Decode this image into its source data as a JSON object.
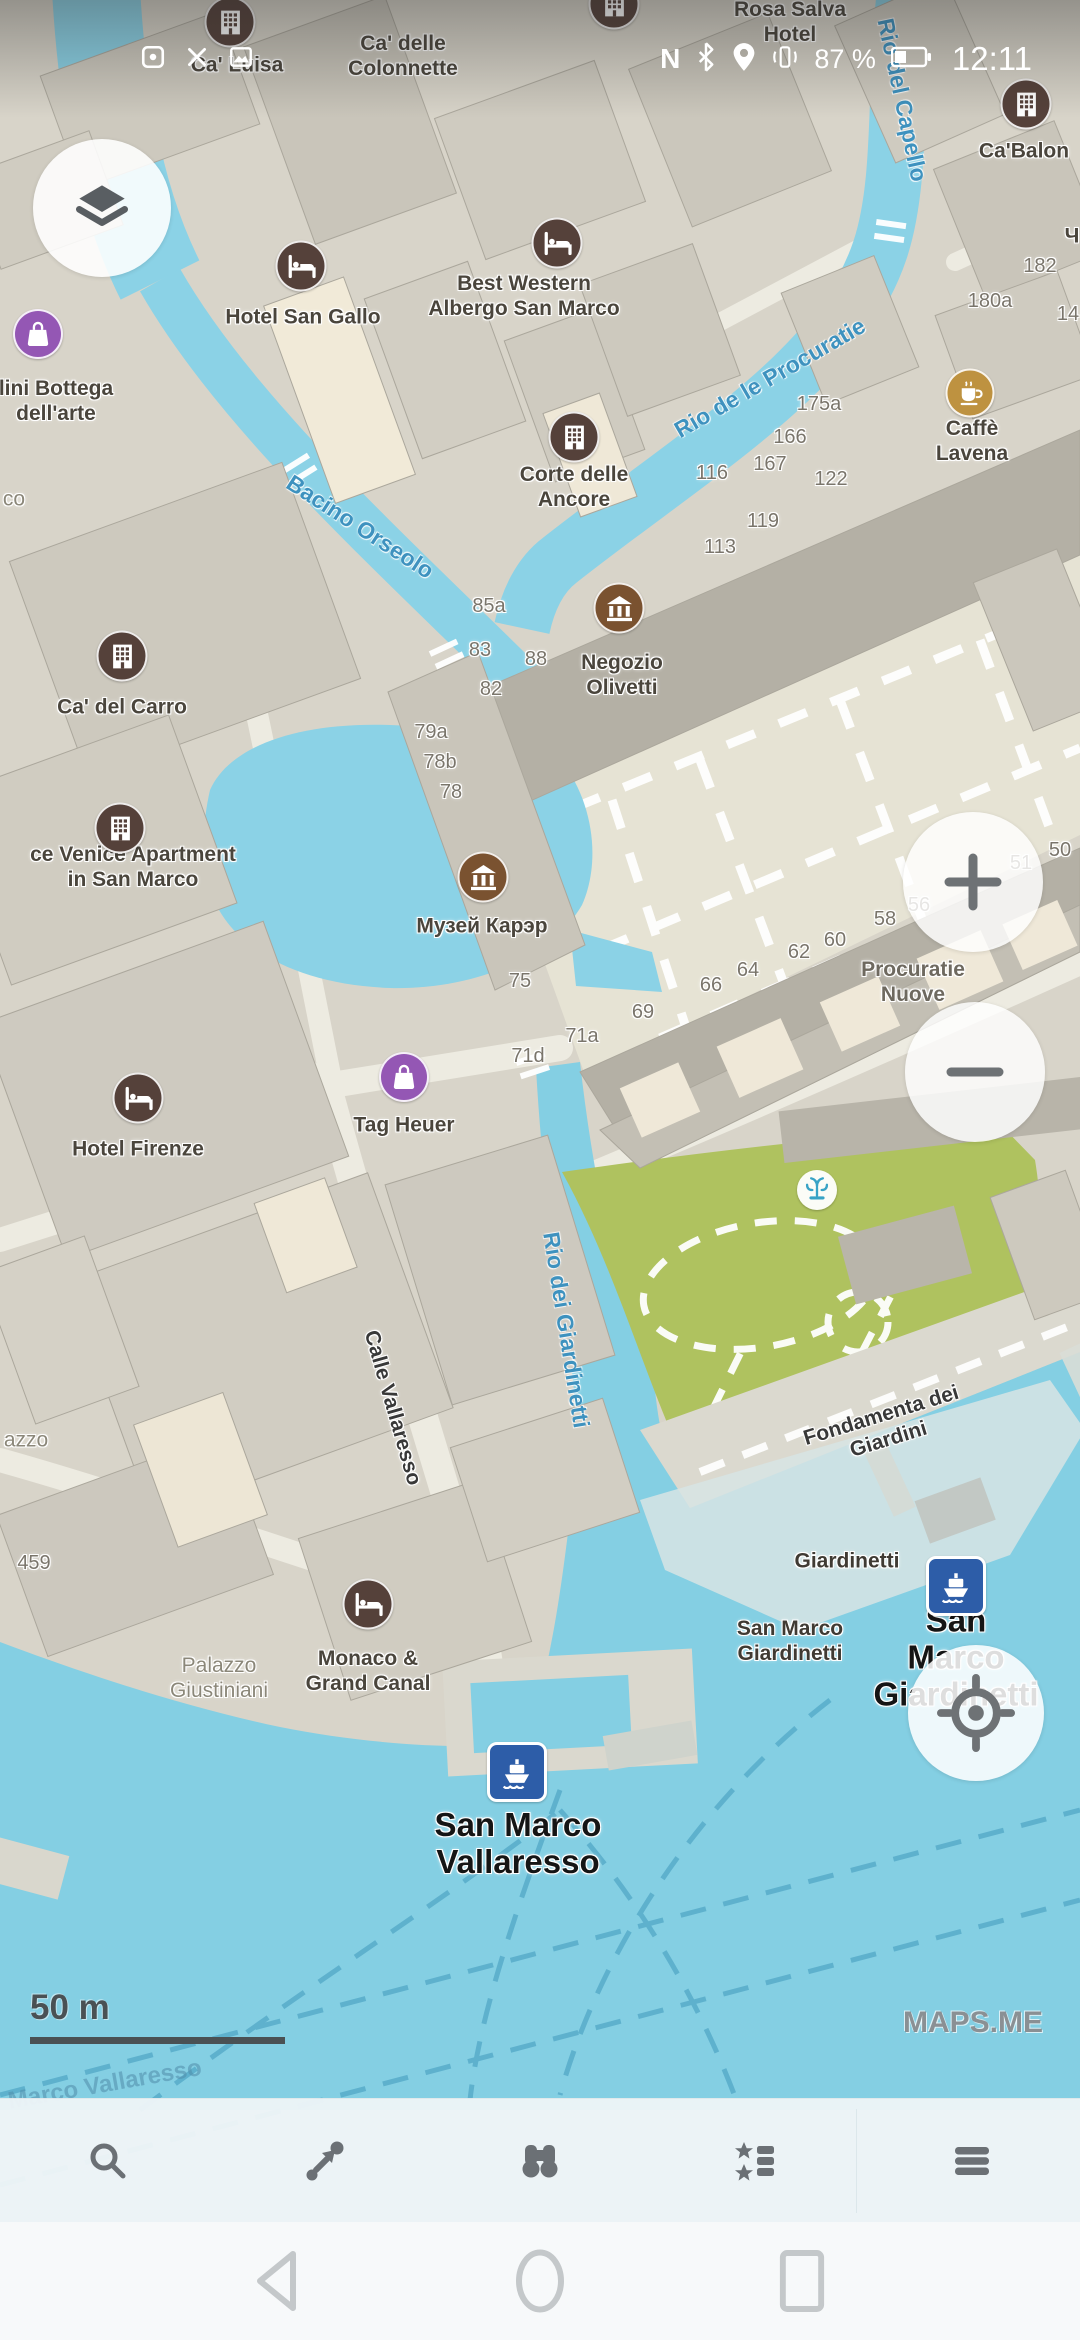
{
  "status_bar": {
    "time": "12:11",
    "battery_text": "87 %",
    "battery_level": 0.37,
    "left_icons": [
      "notification-app-icon",
      "notification-close-icon",
      "notification-screenshot-icon"
    ],
    "right_icons": [
      "nfc-icon",
      "bluetooth-icon",
      "location-icon",
      "vibrate-icon",
      "battery-icon"
    ],
    "nfc_letter": "N"
  },
  "map": {
    "attribution": "MAPS.ME",
    "scale": {
      "label": "50 m"
    },
    "colors": {
      "water": "#84CFE3",
      "canal": "#8BD2E6",
      "land": "#D8D4C9",
      "piazza": "#E6E3D4",
      "park": "#AFC25F",
      "building": "#CFCBC0",
      "building_dark": "#B4B0A5",
      "building_cream": "#F1EAD8",
      "poi_brown": "#55413A",
      "poi_museum": "#7A5230",
      "poi_cafe": "#BE9240",
      "poi_shop": "#9457B4",
      "poi_ferry": "#2D5DA8",
      "label_water": "#3E92BF"
    },
    "labels": [
      {
        "t": "Ca' delle\nColonnette",
        "x": 403,
        "y": 57,
        "cls": "poi",
        "n": "label-ca-delle-colonnette",
        "i": true
      },
      {
        "t": "Ca' Luisa",
        "x": 237,
        "y": 66,
        "cls": "poi",
        "n": "label-ca-luisa",
        "i": true
      },
      {
        "t": "Rosa Salva\nHotel",
        "x": 790,
        "y": 23,
        "cls": "poi",
        "n": "label-rosa-salva-hotel",
        "i": true
      },
      {
        "t": "Ca'Balon",
        "x": 1024,
        "y": 152,
        "cls": "poi",
        "n": "label-ca-balon",
        "i": true
      },
      {
        "t": "Hotel San Gallo",
        "x": 303,
        "y": 318,
        "cls": "poi",
        "n": "label-hotel-san-gallo",
        "i": true
      },
      {
        "t": "Best Western\nAlbergo San Marco",
        "x": 524,
        "y": 297,
        "cls": "poi",
        "n": "label-best-western",
        "i": true
      },
      {
        "t": "Corte delle\nAncore",
        "x": 574,
        "y": 488,
        "cls": "poi",
        "n": "label-corte-delle-ancore",
        "i": true
      },
      {
        "t": "Caffè Lavena",
        "x": 972,
        "y": 442,
        "cls": "poi",
        "n": "label-caffe-lavena",
        "i": true
      },
      {
        "t": "Negozio\nOlivetti",
        "x": 622,
        "y": 676,
        "cls": "poi",
        "n": "label-negozio-olivetti",
        "i": true
      },
      {
        "t": "Музей Карэр",
        "x": 482,
        "y": 927,
        "cls": "poi",
        "n": "label-musei-karer",
        "i": true
      },
      {
        "t": "Ca' del Carro",
        "x": 122,
        "y": 708,
        "cls": "poi",
        "n": "label-ca-del-carro",
        "i": true
      },
      {
        "t": "ce Venice Apartment\nin San Marco",
        "x": 133,
        "y": 868,
        "cls": "poi",
        "n": "label-venice-apartment",
        "i": true
      },
      {
        "t": "Procuratie\nNuove",
        "x": 913,
        "y": 983,
        "cls": "poi-muted",
        "n": "label-procuratie-nuove",
        "i": false
      },
      {
        "t": "Hotel Firenze",
        "x": 138,
        "y": 1150,
        "cls": "poi",
        "n": "label-hotel-firenze",
        "i": true
      },
      {
        "t": "Tag Heuer",
        "x": 404,
        "y": 1126,
        "cls": "poi",
        "n": "label-tag-heuer",
        "i": true
      },
      {
        "t": "lini Bottega\ndell'arte",
        "x": 56,
        "y": 402,
        "cls": "poi",
        "n": "label-bottega-dellarte",
        "i": true
      },
      {
        "t": "Palazzo\nGiustiniani",
        "x": 219,
        "y": 1679,
        "cls": "area",
        "n": "label-palazzo-giustiniani",
        "i": false
      },
      {
        "t": "Monaco &\nGrand Canal",
        "x": 368,
        "y": 1672,
        "cls": "poi",
        "n": "label-monaco-grand-canal",
        "i": true
      },
      {
        "t": "San Marco\nVallaresso",
        "x": 518,
        "y": 1844,
        "cls": "stop",
        "n": "label-stop-san-marco-vallaresso",
        "i": true
      },
      {
        "t": "San Marco\nGiardinetti",
        "x": 956,
        "y": 1658,
        "cls": "stop",
        "n": "label-stop-san-marco-giardinetti",
        "i": true
      },
      {
        "t": "San Marco\nGiardinetti",
        "x": 790,
        "y": 1642,
        "cls": "stop-sm",
        "n": "label-san-marco-giardinetti-small",
        "i": true
      },
      {
        "t": "Giardinetti",
        "x": 847,
        "y": 1562,
        "cls": "stop-sm",
        "n": "label-giardinetti",
        "i": true
      },
      {
        "t": "Fondamenta dei Giardini",
        "x": 885,
        "y": 1428,
        "cls": "street",
        "rot": -17,
        "n": "label-fondamenta-dei-giardini",
        "i": false
      },
      {
        "t": "Calle Vallaresso",
        "x": 392,
        "y": 1408,
        "cls": "street",
        "rot": 74,
        "n": "label-calle-vallaresso",
        "i": false
      },
      {
        "t": "Bacino Orseolo",
        "x": 360,
        "y": 527,
        "cls": "water-lbl",
        "rot": 33,
        "n": "label-bacino-orseolo",
        "i": false
      },
      {
        "t": "Rio de le Procuratie",
        "x": 770,
        "y": 378,
        "cls": "water-lbl",
        "rot": -30,
        "n": "label-rio-de-le-procuratie",
        "i": false
      },
      {
        "t": "Rio del Capello",
        "x": 902,
        "y": 100,
        "cls": "water-lbl",
        "rot": 78,
        "n": "label-rio-del-capello",
        "i": false
      },
      {
        "t": "Rio dei Giardinetti",
        "x": 566,
        "y": 1330,
        "cls": "water-lbl",
        "rot": 81,
        "n": "label-rio-dei-giardinetti",
        "i": false
      },
      {
        "t": "Marco Vallaresso",
        "x": 105,
        "y": 2085,
        "cls": "route-lbl",
        "rot": -10,
        "n": "label-ferry-route",
        "i": false
      },
      {
        "t": "co",
        "x": 14,
        "y": 500,
        "cls": "area",
        "n": "label-cut-co",
        "i": false
      },
      {
        "t": "azzo",
        "x": 26,
        "y": 1441,
        "cls": "area",
        "n": "label-cut-azzo",
        "i": false
      },
      {
        "t": "Ч",
        "x": 1072,
        "y": 237,
        "cls": "poi",
        "n": "label-cut-ch",
        "i": false
      }
    ],
    "house_numbers": [
      {
        "t": "175a",
        "x": 819,
        "y": 405
      },
      {
        "t": "166",
        "x": 790,
        "y": 438
      },
      {
        "t": "167",
        "x": 770,
        "y": 465
      },
      {
        "t": "116",
        "x": 712,
        "y": 474
      },
      {
        "t": "122",
        "x": 831,
        "y": 480
      },
      {
        "t": "119",
        "x": 763,
        "y": 522
      },
      {
        "t": "113",
        "x": 720,
        "y": 548
      },
      {
        "t": "85a",
        "x": 489,
        "y": 607
      },
      {
        "t": "83",
        "x": 480,
        "y": 651
      },
      {
        "t": "88",
        "x": 536,
        "y": 660
      },
      {
        "t": "82",
        "x": 491,
        "y": 690
      },
      {
        "t": "79a",
        "x": 431,
        "y": 733
      },
      {
        "t": "78b",
        "x": 440,
        "y": 763
      },
      {
        "t": "78",
        "x": 451,
        "y": 793
      },
      {
        "t": "75",
        "x": 520,
        "y": 982
      },
      {
        "t": "71a",
        "x": 582,
        "y": 1037
      },
      {
        "t": "71d",
        "x": 528,
        "y": 1057
      },
      {
        "t": "69",
        "x": 643,
        "y": 1013
      },
      {
        "t": "66",
        "x": 711,
        "y": 986
      },
      {
        "t": "64",
        "x": 748,
        "y": 971
      },
      {
        "t": "62",
        "x": 799,
        "y": 953
      },
      {
        "t": "60",
        "x": 835,
        "y": 941
      },
      {
        "t": "58",
        "x": 885,
        "y": 920
      },
      {
        "t": "56",
        "x": 919,
        "y": 906
      },
      {
        "t": "51",
        "x": 1021,
        "y": 864
      },
      {
        "t": "50",
        "x": 1060,
        "y": 851
      },
      {
        "t": "182",
        "x": 1040,
        "y": 267
      },
      {
        "t": "180a",
        "x": 990,
        "y": 302
      },
      {
        "t": "14",
        "x": 1068,
        "y": 315
      },
      {
        "t": "459",
        "x": 34,
        "y": 1564
      }
    ],
    "pois": [
      {
        "type": "building",
        "x": 230,
        "y": 22,
        "n": "ca-luisa"
      },
      {
        "type": "building",
        "x": 614,
        "y": 4,
        "n": "colonnette"
      },
      {
        "type": "building",
        "x": 1026,
        "y": 104,
        "n": "ca-balon"
      },
      {
        "type": "bed",
        "x": 301,
        "y": 266,
        "n": "hotel-san-gallo"
      },
      {
        "type": "bed",
        "x": 557,
        "y": 243,
        "n": "best-western"
      },
      {
        "type": "building",
        "x": 574,
        "y": 437,
        "n": "corte-delle-ancore"
      },
      {
        "type": "cafe",
        "x": 970,
        "y": 393,
        "n": "caffe-lavena"
      },
      {
        "type": "museum",
        "x": 619,
        "y": 608,
        "n": "negozio-olivetti"
      },
      {
        "type": "building",
        "x": 122,
        "y": 656,
        "n": "ca-del-carro"
      },
      {
        "type": "building",
        "x": 120,
        "y": 828,
        "n": "venice-apartment"
      },
      {
        "type": "museum",
        "x": 483,
        "y": 877,
        "n": "musei-karer"
      },
      {
        "type": "bed",
        "x": 138,
        "y": 1098,
        "n": "hotel-firenze"
      },
      {
        "type": "shop",
        "x": 404,
        "y": 1077,
        "n": "tag-heuer"
      },
      {
        "type": "shop",
        "x": 38,
        "y": 334,
        "n": "bottega-dellarte"
      },
      {
        "type": "bed",
        "x": 368,
        "y": 1604,
        "n": "monaco-grand-canal"
      },
      {
        "type": "ferry",
        "x": 956,
        "y": 1586,
        "n": "giardinetti-ferry-stop"
      },
      {
        "type": "ferry",
        "x": 517,
        "y": 1772,
        "n": "vallaresso-ferry-stop"
      },
      {
        "type": "fountain",
        "x": 817,
        "y": 1190,
        "n": "park-fountain"
      }
    ]
  },
  "controls": {
    "layers": "layers-button",
    "zoom_in": "+",
    "zoom_out": "−",
    "my_location": "my-location-button"
  },
  "toolbar": {
    "items": [
      {
        "n": "search-button",
        "icon": "search-icon"
      },
      {
        "n": "route-button",
        "icon": "route-icon"
      },
      {
        "n": "discovery-button",
        "icon": "binoculars-icon"
      },
      {
        "n": "bookmarks-button",
        "icon": "bookmarks-icon"
      },
      {
        "n": "menu-button",
        "icon": "menu-icon"
      }
    ]
  },
  "nav_bar": {
    "items": [
      {
        "n": "back-button",
        "icon": "back-icon"
      },
      {
        "n": "home-button",
        "icon": "home-icon"
      },
      {
        "n": "recents-button",
        "icon": "recents-icon"
      }
    ]
  }
}
